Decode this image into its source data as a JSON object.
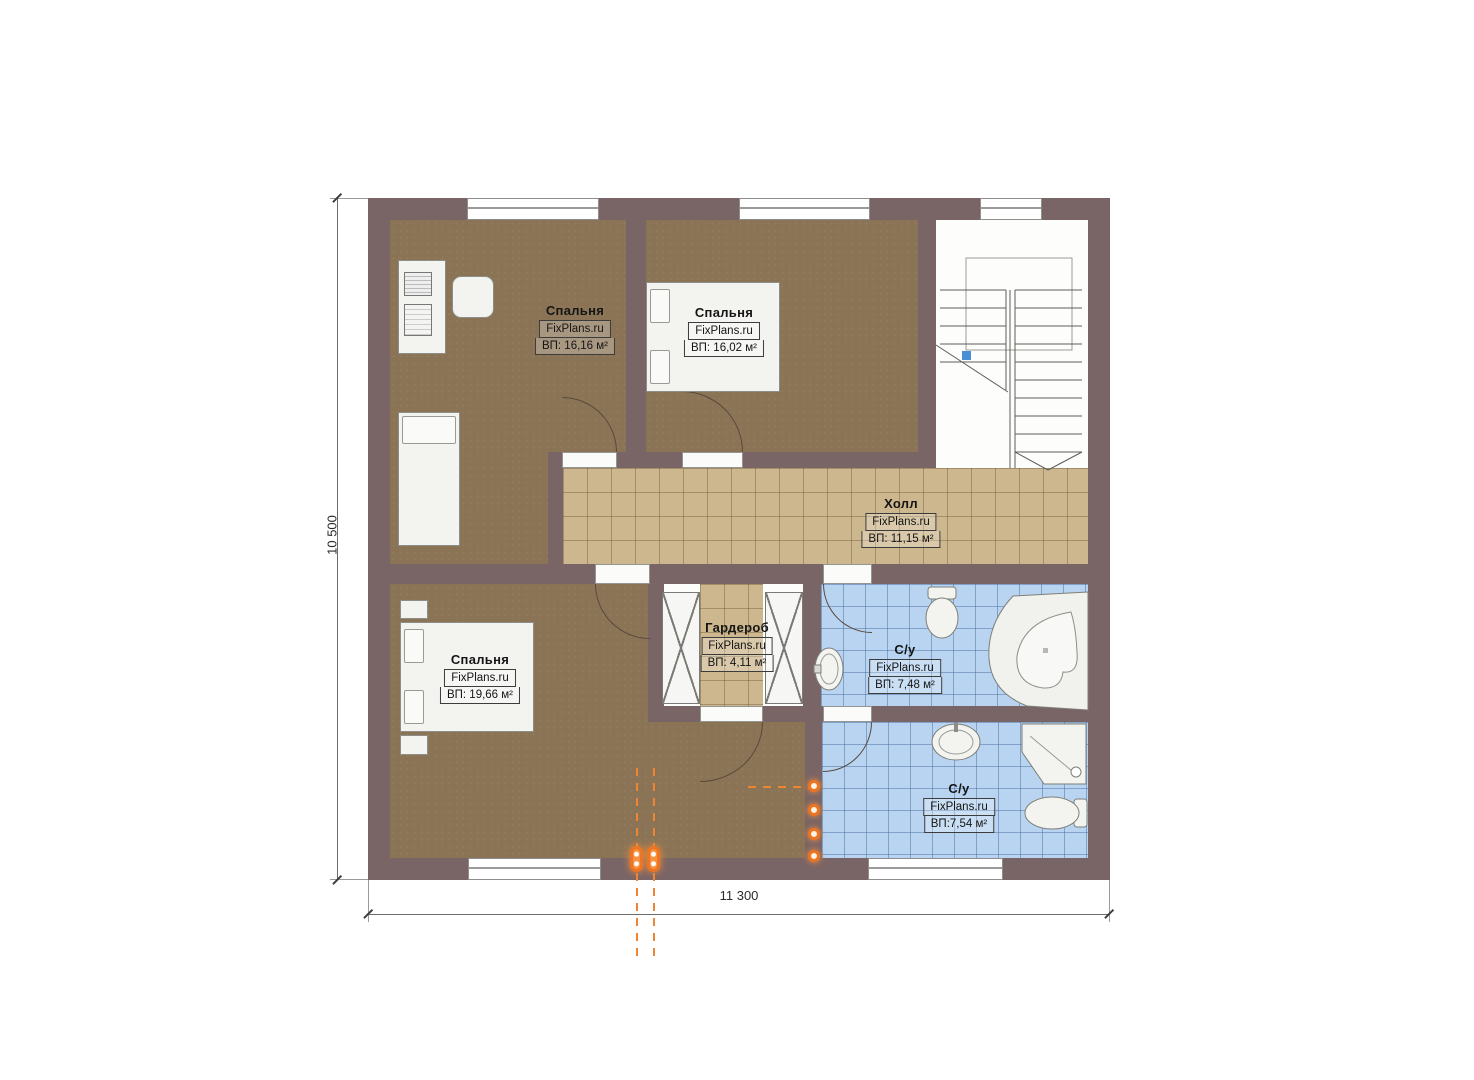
{
  "plan": {
    "brand": "FixPlans.ru",
    "rooms": [
      {
        "id": "bedroom-top-left",
        "name": "Спальня",
        "brand": "FixPlans.ru",
        "area": "ВП: 16,16 м²"
      },
      {
        "id": "bedroom-top-middle",
        "name": "Спальня",
        "brand": "FixPlans.ru",
        "area": "ВП: 16,02 м²"
      },
      {
        "id": "hall",
        "name": "Холл",
        "brand": "FixPlans.ru",
        "area": "ВП: 11,15 м²"
      },
      {
        "id": "bedroom-bottom",
        "name": "Спальня",
        "brand": "FixPlans.ru",
        "area": "ВП: 19,66 м²"
      },
      {
        "id": "wardrobe",
        "name": "Гардероб",
        "brand": "FixPlans.ru",
        "area": "ВП: 4,11 м²"
      },
      {
        "id": "bathroom-top",
        "name": "С/у",
        "brand": "FixPlans.ru",
        "area": "ВП: 7,48 м²"
      },
      {
        "id": "bathroom-bottom",
        "name": "С/у",
        "brand": "FixPlans.ru",
        "area": "ВП:7,54 м²"
      }
    ],
    "dimensions": {
      "height_label": "10 500",
      "width_label": "11 300"
    },
    "colors": {
      "wall": "#7a6566",
      "wood_floor": "#8b7456",
      "tile_tan": "#cdb78e",
      "tile_blue": "#b9d4f0",
      "accent_orange": "#ee7420",
      "fixture_white": "#f3f3f0",
      "stair_marker_blue": "#4a8fd4"
    }
  }
}
